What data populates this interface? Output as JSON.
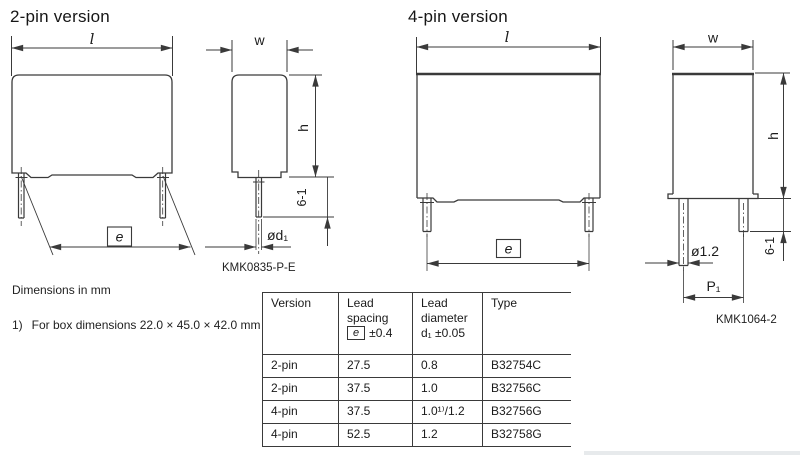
{
  "sections": {
    "two_pin": {
      "title": "2-pin version",
      "code": "KMK0835-P-E",
      "dims": {
        "length": "l",
        "spacing": "e",
        "width": "w",
        "height": "h",
        "lead_length": "6-1",
        "lead_diameter": "ød₁"
      }
    },
    "four_pin": {
      "title": "4-pin version",
      "code": "KMK1064-2",
      "dims": {
        "length": "l",
        "spacing": "e",
        "width": "w",
        "height": "h",
        "lead_length": "6-1",
        "lead_diameter": "ø1.2",
        "pitch": "P₁"
      }
    }
  },
  "notes": {
    "units": "Dimensions in mm",
    "footnote_marker": "1)",
    "footnote": "For box dimensions 22.0 × 45.0 × 42.0 mm"
  },
  "table": {
    "headers": {
      "version": "Version",
      "spacing_line1": "Lead",
      "spacing_line2": "spacing",
      "spacing_datum": "e",
      "spacing_tol": "±0.4",
      "diameter_line1": "Lead",
      "diameter_line2": "diameter",
      "diameter_line3": "d₁ ±0.05",
      "type": "Type"
    },
    "rows": [
      {
        "version": "2-pin",
        "spacing": "27.5",
        "diameter": "0.8",
        "type": "B32754C"
      },
      {
        "version": "2-pin",
        "spacing": "37.5",
        "diameter": "1.0",
        "type": "B32756C"
      },
      {
        "version": "4-pin",
        "spacing": "37.5",
        "diameter": "1.0¹⁾/1.2",
        "type": "B32756G"
      },
      {
        "version": "4-pin",
        "spacing": "52.5",
        "diameter": "1.2",
        "type": "B32758G"
      }
    ]
  }
}
